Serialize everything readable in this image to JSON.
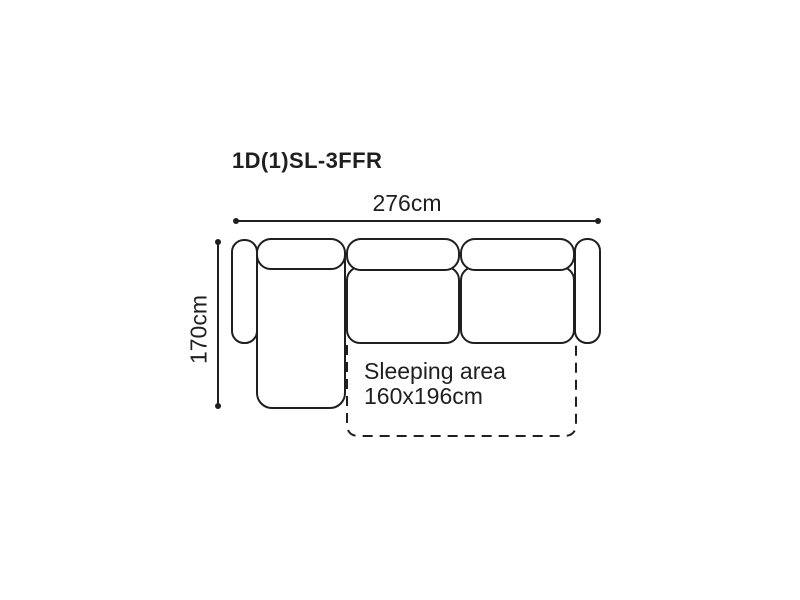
{
  "page": {
    "background": "#ffffff"
  },
  "diagram": {
    "model_code": "1D(1)SL-3FFR",
    "line_color": "#1f1f1f",
    "dimensions": {
      "width": {
        "label": "276cm"
      },
      "depth": {
        "label": "170cm"
      }
    },
    "sleeping_area": {
      "line1": "Sleeping area",
      "line2": "160x196cm"
    }
  }
}
